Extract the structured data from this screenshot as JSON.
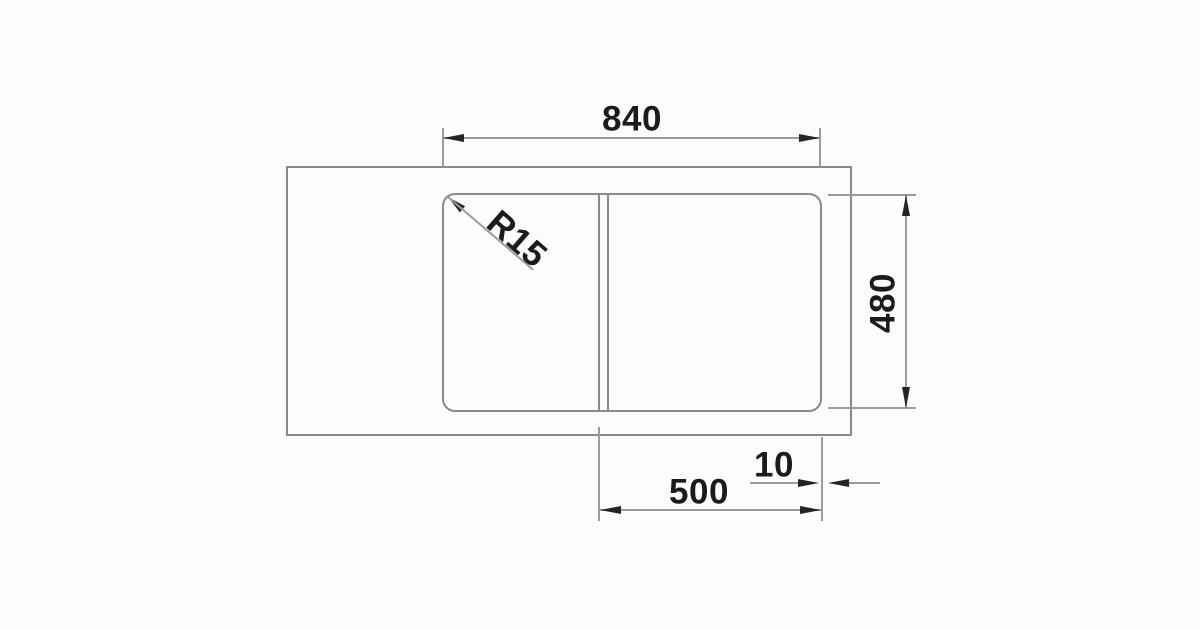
{
  "drawing": {
    "labels": {
      "overall_width": "840",
      "overall_depth": "480",
      "corner_radius": "R15",
      "bowl_width": "500",
      "edge_gap": "10"
    },
    "colors": {
      "background": "#fcfcfc",
      "outline": "#8a8a8a",
      "dim-line": "#9b9b9b",
      "arrow": "#242424",
      "text": "#1b1b1b"
    }
  }
}
